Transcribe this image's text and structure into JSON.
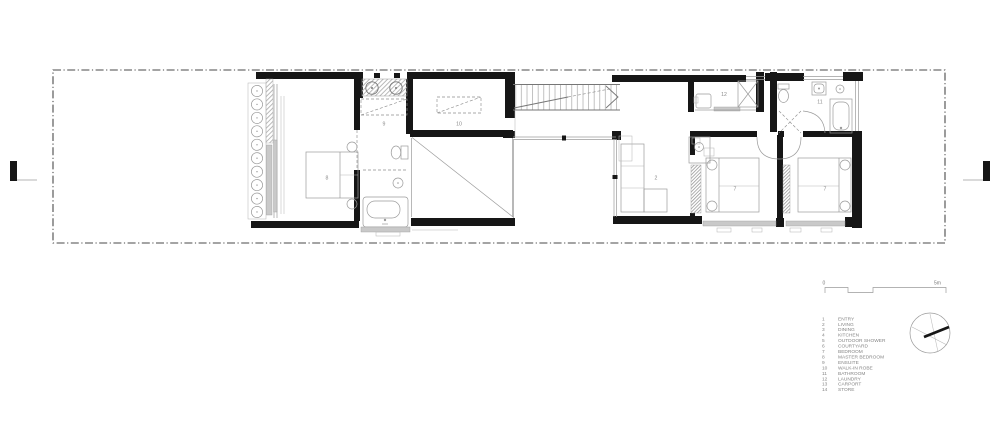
{
  "plan": {
    "room_labels": [
      {
        "text": "8"
      },
      {
        "text": "9"
      },
      {
        "text": "10"
      },
      {
        "text": "2"
      },
      {
        "text": "12"
      },
      {
        "text": "11"
      },
      {
        "text": "7"
      },
      {
        "text": "7"
      }
    ]
  },
  "legend": {
    "items": [
      {
        "num": "1",
        "name": "ENTRY"
      },
      {
        "num": "2",
        "name": "LIVING"
      },
      {
        "num": "3",
        "name": "DINING"
      },
      {
        "num": "4",
        "name": "KITCHEN"
      },
      {
        "num": "5",
        "name": "OUTDOOR SHOWER"
      },
      {
        "num": "6",
        "name": "COURTYARD"
      },
      {
        "num": "7",
        "name": "BEDROOM"
      },
      {
        "num": "8",
        "name": "MASTER BEDROOM"
      },
      {
        "num": "9",
        "name": "ENSUITE"
      },
      {
        "num": "10",
        "name": "WALK-IN ROBE"
      },
      {
        "num": "11",
        "name": "BATHROOM"
      },
      {
        "num": "12",
        "name": "LAUNDRY"
      },
      {
        "num": "13",
        "name": "CARPORT"
      },
      {
        "num": "14",
        "name": "STORE"
      }
    ]
  },
  "scale_bar": {
    "start_label": "0",
    "end_label": "5m"
  },
  "colors": {
    "wall": "#161616",
    "linework": "#9b9b9b",
    "text": "#8a8a8a",
    "boundary": "#4a4a4a",
    "glazing_fill": "#c9c9c9"
  }
}
